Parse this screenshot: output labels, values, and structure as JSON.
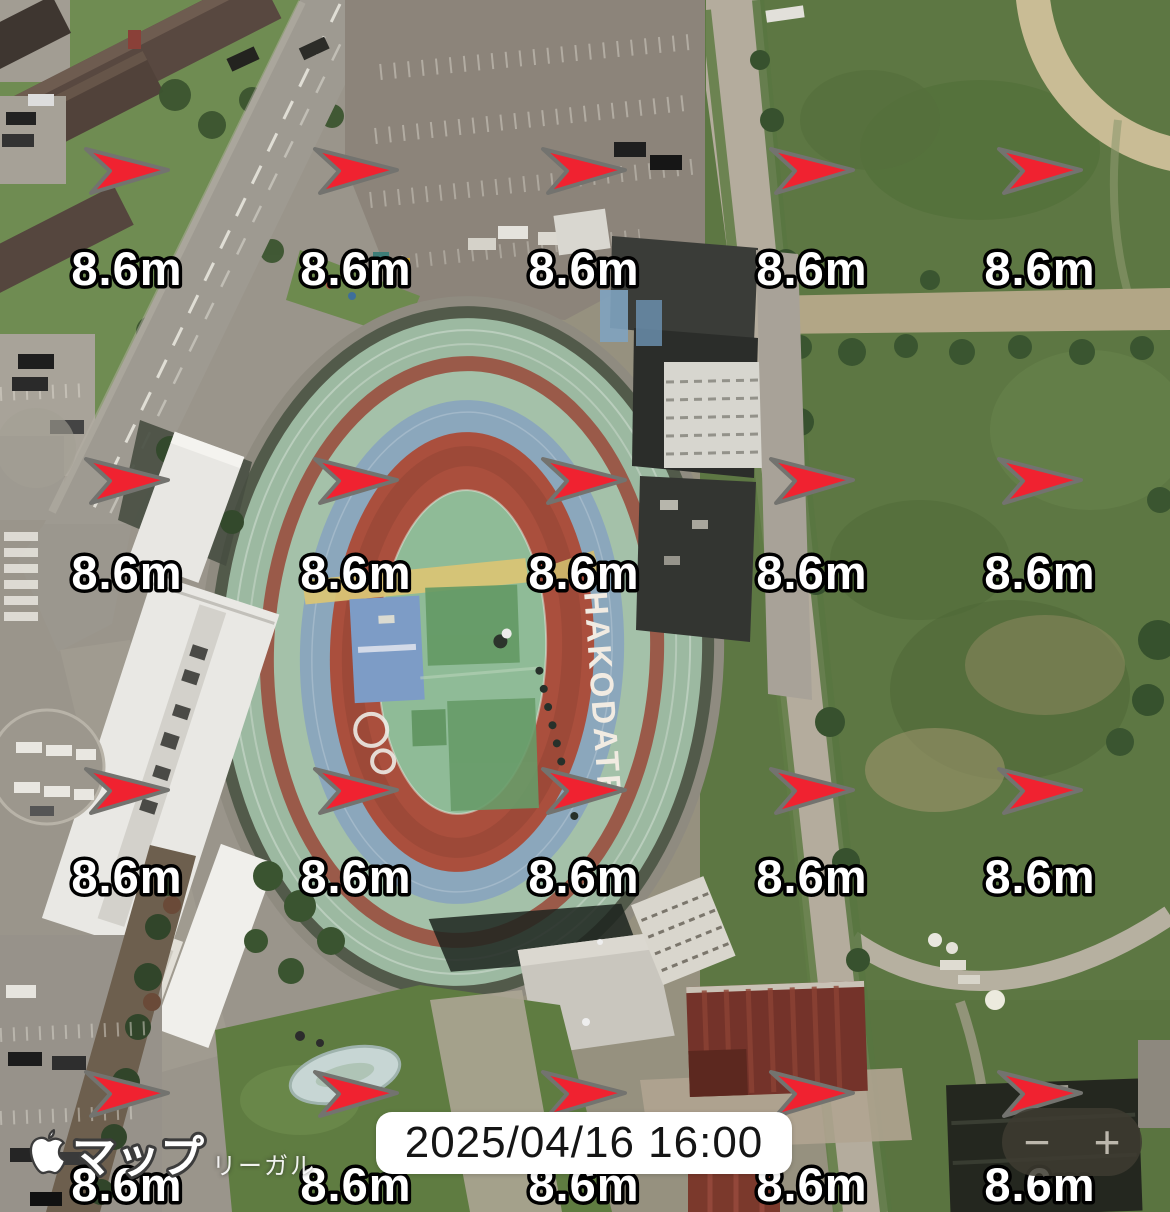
{
  "map": {
    "provider_label": "マップ",
    "legal_label": "リーガル",
    "stadium_text": "HAKODATE",
    "timestamp": "2025/04/16 16:00"
  },
  "wind_overlay": {
    "value_label": "8.6m",
    "direction": "east",
    "arrow_color": "#f puis2230",
    "columns_x": [
      127,
      356,
      584,
      812,
      1040
    ],
    "arrow_rows_y": [
      171,
      481,
      791,
      1094
    ],
    "label_rows_y": [
      268,
      572,
      876,
      1184
    ]
  },
  "controls": {
    "zoom_out_label": "−",
    "zoom_in_label": "+"
  },
  "colors": {
    "arrow_fill": "#f02230",
    "arrow_outline": "#73736f",
    "label_fill": "#ffffff",
    "label_outline": "#000000",
    "time_chip_bg": "#ffffff",
    "time_chip_text": "#151515",
    "zoom_pill_bg": "rgba(62,59,49,0.86)",
    "zoom_icon_color": "#bcb7ac"
  }
}
